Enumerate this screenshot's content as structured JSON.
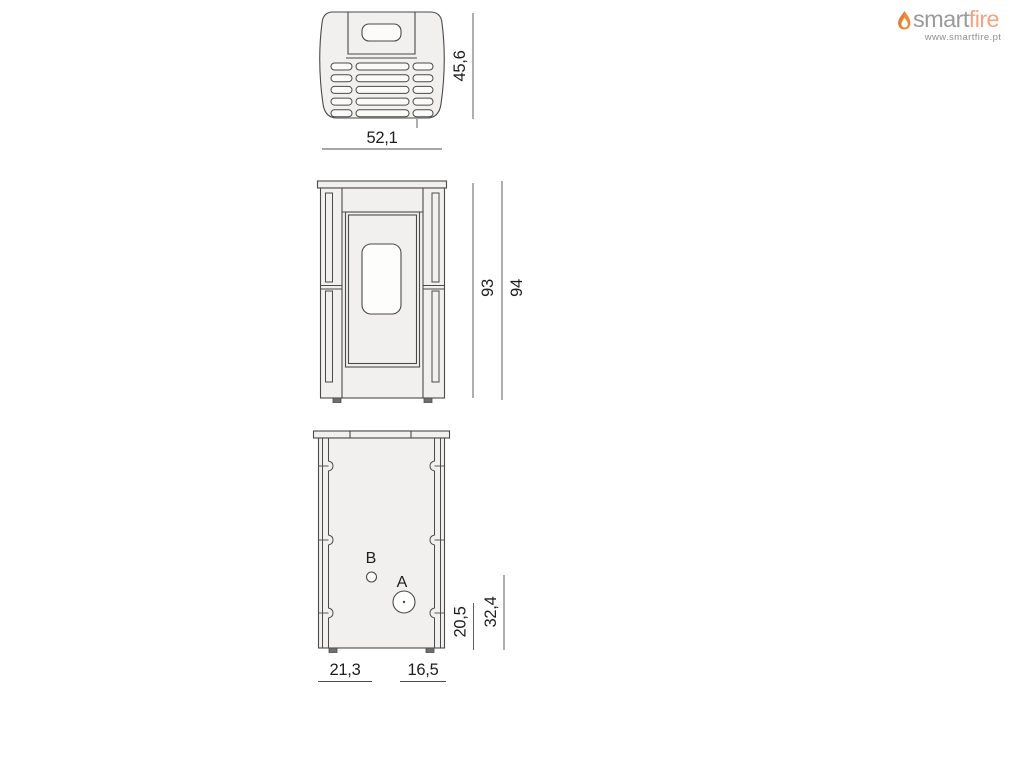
{
  "logo": {
    "brand_part1": "smart",
    "brand_part2": "fire",
    "website": "www.smartfire.pt",
    "colors": {
      "flame": "#ef8a3a",
      "flame_dark": "#e2702a",
      "smart": "#9a9a9a",
      "fire": "#f4a383",
      "url": "#8f8f8f"
    }
  },
  "drawing": {
    "colors": {
      "fill": "#f2f0ee",
      "inner_fill": "#fcfbfa",
      "stroke": "#4a4a4a",
      "dim_line": "#4c4c4c",
      "text": "#1d1d1d",
      "feet": "#6f6f6f"
    },
    "top_view": {
      "width_cm": "52,1",
      "depth_cm": "45,6"
    },
    "front_view": {
      "height_body_cm": "93",
      "height_total_cm": "94"
    },
    "rear_view": {
      "label_a": "A",
      "label_b": "B",
      "offset_left_cm": "21,3",
      "offset_right_cm": "16,5",
      "height_a_cm": "20,5",
      "height_b_cm": "32,4"
    }
  }
}
